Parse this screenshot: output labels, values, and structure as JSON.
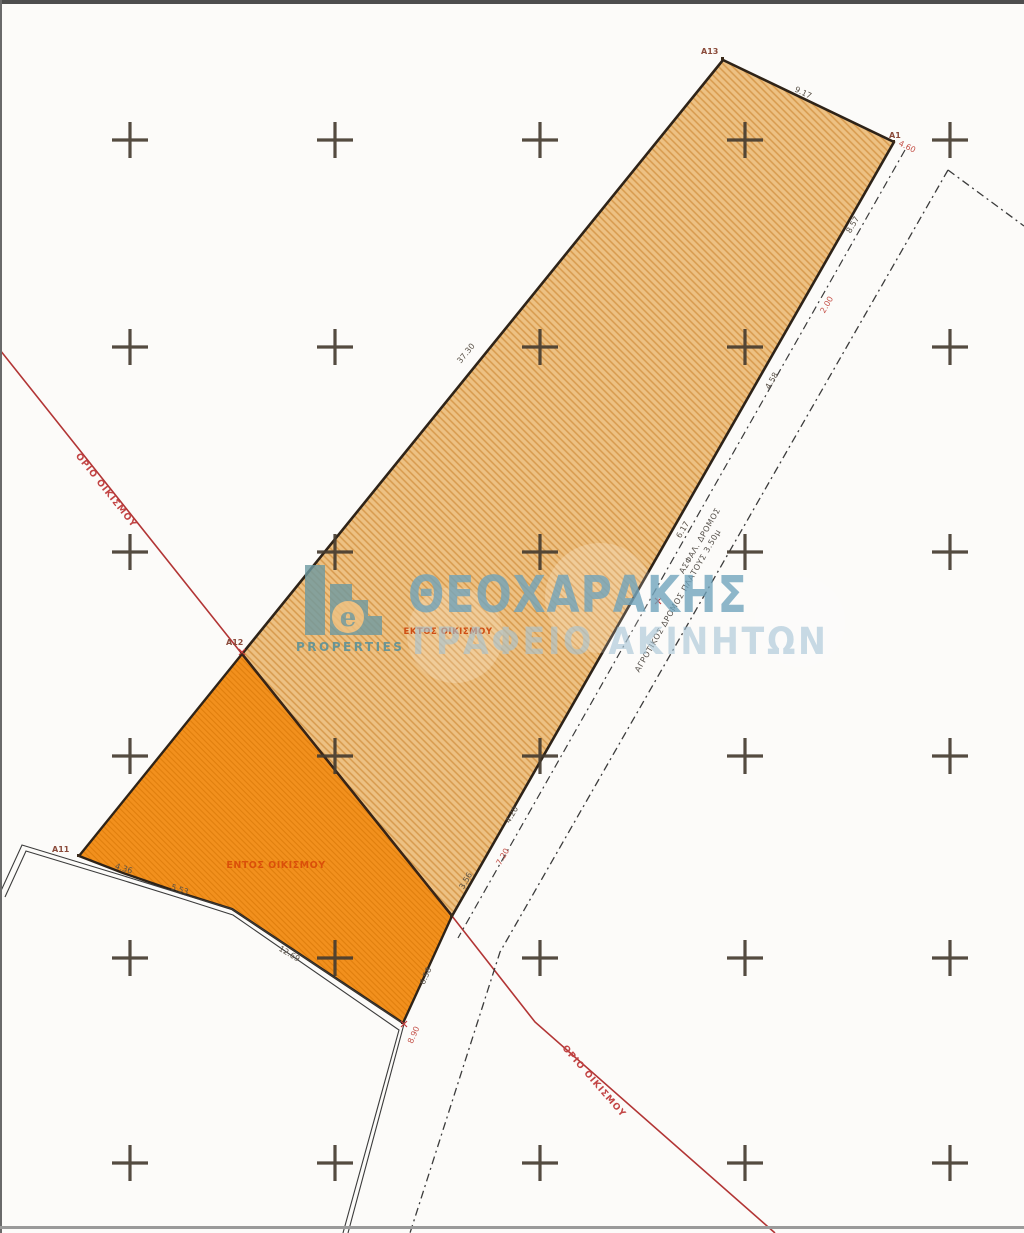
{
  "document_type": "cadastral-site-plan",
  "watermark": {
    "brand": "ΘΕΟΧΑΡΑΚΗΣ",
    "subtitle": "ΓΡΑΦΕΙΟ ΑΚΙΝΗΤΩΝ",
    "logo_caption": "PROPERTIES",
    "logo_icon": "buildings-e-logo"
  },
  "regions": {
    "outside_label": "ΕΚΤΟΣ ΟΙΚΙΣΜΟΥ",
    "inside_label": "ΕΝΤΟΣ ΟΙΚΙΣΜΟΥ"
  },
  "boundary": {
    "label_upper": "ΟΡΙΟ ΟΙΚΙΣΜΟΥ",
    "label_lower": "ΟΡΙΟ ΟΙΚΙΣΜΟΥ"
  },
  "roads": {
    "label_1": "ΑΣΦΑΛ. ΔΡΟΜΟΣ",
    "label_2": "ΑΓΡΟΤΙΚΟΣ ΔΡΟΜΟΣ ΠΛΑΤΟΥΣ 3.50μ"
  },
  "vertices": {
    "a13": "Α13",
    "a1": "Α1",
    "a12": "Α12",
    "a11": "Α11"
  },
  "dimensions": {
    "top_edge": "9.17",
    "right_1": "8.57",
    "right_2": "2.00",
    "right_3": "4.58",
    "right_4": "6.17",
    "left_edge": "37.30",
    "road_1": "4.20",
    "road_2": "7.20",
    "road_3": "3.56",
    "lower_right": "6.58",
    "lower_red": "8.90",
    "corner_offset": "4.60",
    "bottom_1": "4.36",
    "bottom_2": "5.53",
    "bottom_3": "12.69"
  },
  "colors": {
    "parcel_outside_fill": "#edc183",
    "parcel_outside_hatch": "#d79a4d",
    "parcel_inside_fill": "#f2901d",
    "parcel_inside_hatch": "#e07f0d",
    "parcel_stroke": "#2e2318",
    "settlement_boundary_red": "#b23535",
    "watermark_blue": "#6ea3bc",
    "watermark_light_blue": "#a4c4d6",
    "logo_teal": "#6d9aa2",
    "grid_cross": "#453c30"
  }
}
